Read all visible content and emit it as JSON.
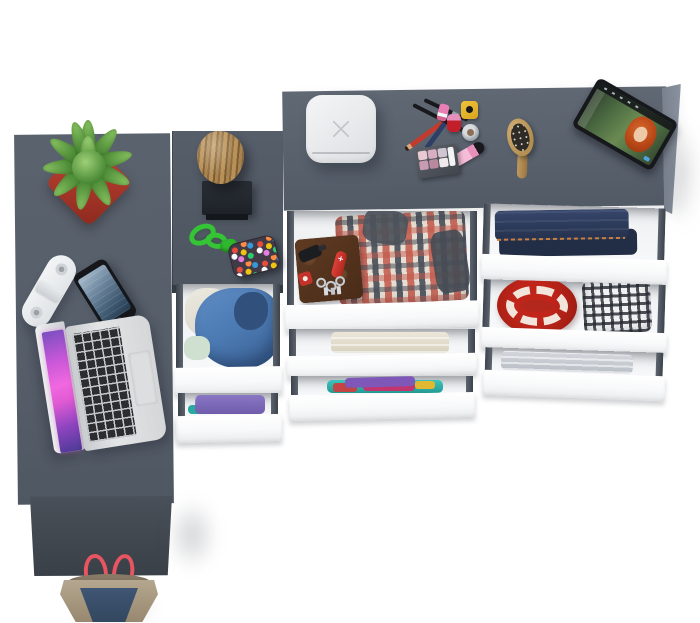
{
  "scene": {
    "title": "Top-down view of a gray corner desk and chest of drawers with open drawers full of clothes and accessories",
    "background_color": "#ffffff"
  },
  "palette": {
    "desk_surface": "#5a626e",
    "cabinet_surface": "#525a66",
    "dresser_surface": "#5d6571",
    "desk_side_panel": "#40464f",
    "drawer_front": "#ffffff",
    "drawer_wall": "#454c56",
    "drawer_interior": "#f1f2f4"
  },
  "desk_items": [
    {
      "id": "succulent-plant",
      "label": "Green succulent in red square pot",
      "colors": [
        "#4e8f3a",
        "#b23b2e"
      ]
    },
    {
      "id": "white-speaker",
      "label": "White capsule portable speaker",
      "colors": [
        "#eef0f2"
      ]
    },
    {
      "id": "smartphone",
      "label": "Black smartphone with blue screen",
      "colors": [
        "#17191c",
        "#6d86a0"
      ]
    },
    {
      "id": "laptop",
      "label": "Silver laptop with pink galaxy wallpaper, black keys and trackpad",
      "colors": [
        "#d5d7d9",
        "#e45fd0",
        "#2b2d30"
      ]
    }
  ],
  "cabinet_items": [
    {
      "id": "wood-stump",
      "label": "Decorative wooden stump on black wall bracket",
      "colors": [
        "#b08d57",
        "#23272e"
      ]
    },
    {
      "id": "green-lanyard",
      "label": "Green paracord lanyard knot",
      "colors": [
        "#35c435"
      ]
    },
    {
      "id": "beaded-pouch",
      "label": "Dark pouch covered in multicolor beads",
      "colors": [
        "#423a46",
        "#e74c3c",
        "#f1c40f",
        "#3498db",
        "#2ecc71"
      ]
    }
  ],
  "dresser_items": [
    {
      "id": "storage-box",
      "label": "White rounded storage box with cross mark",
      "colors": [
        "#eceef0"
      ]
    },
    {
      "id": "makeup-set",
      "label": "Makeup: crossed pencils and brushes, nail polishes, lip gloss, jar, eyeshadow palette",
      "colors": [
        "#c23b2d",
        "#2e3f66",
        "#edc33a",
        "#f4bcd6",
        "#c21f2a"
      ]
    },
    {
      "id": "hairbrush",
      "label": "Wooden hairbrush with dark bristles",
      "colors": [
        "#c09a5f",
        "#2e2a26"
      ]
    },
    {
      "id": "tablet",
      "label": "Black tablet on teal stand playing an animated movie with a red-haired character",
      "colors": [
        "#16181c",
        "#4c6b42",
        "#b84616",
        "#35c4d0"
      ]
    }
  ],
  "drawers": {
    "front_color": "#ffffff",
    "left_column": [
      {
        "contents": "Blue hooded jacket and white shirt",
        "colors": [
          "#4d7cb5",
          "#ece9e0"
        ]
      },
      {
        "contents": "Folded purple and teal clothes",
        "colors": [
          "#8a77c4",
          "#2aa9a0",
          "#c24a50"
        ]
      }
    ],
    "middle_column": [
      {
        "contents": "Brown leather wallet with car key, red pocket knife, keyring and badge, beside a folded red plaid shirt",
        "colors": [
          "#5e3a22",
          "#e04038",
          "#c45a4c",
          "#494f5a"
        ]
      },
      {
        "contents": "Folded cream towel",
        "colors": [
          "#ece7da"
        ]
      },
      {
        "contents": "Stack of teal, purple, magenta, yellow and red clothes",
        "colors": [
          "#3cc4bd",
          "#7e57b8",
          "#c2356e",
          "#e0b832",
          "#c24444"
        ]
      }
    ],
    "right_column": [
      {
        "contents": "Folded blue jeans with orange stitching",
        "colors": [
          "#2c3a5a",
          "#c87f3f"
        ]
      },
      {
        "contents": "Red decorative plate with white pattern and black-and-white checked shirt",
        "colors": [
          "#b3271d",
          "#eff1f2",
          "#23272e"
        ]
      },
      {
        "contents": "Folded gray bed sheet",
        "colors": [
          "#c9ced4"
        ]
      }
    ]
  },
  "floor_items": [
    {
      "id": "tote-bag",
      "label": "Tote bag with khaki body, navy front panel and red straps",
      "colors": [
        "#b5a78f",
        "#3f5573",
        "#e65560"
      ]
    }
  ]
}
